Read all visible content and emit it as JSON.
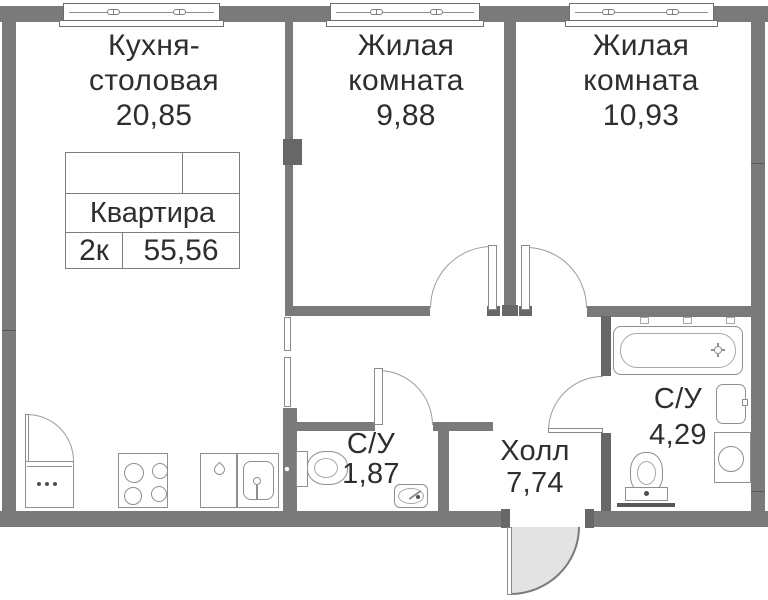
{
  "apartment": {
    "info_box": {
      "title": "Квартира",
      "layout": "2к",
      "total_area": "55,56"
    },
    "rooms": [
      {
        "name": "Кухня-",
        "name2": "столовая",
        "area": "20,85"
      },
      {
        "name": "Жилая",
        "name2": "комната",
        "area": "9,88"
      },
      {
        "name": "Жилая",
        "name2": "комната",
        "area": "10,93"
      },
      {
        "name": "С/У",
        "area": "1,87"
      },
      {
        "name": "Холл",
        "area": "7,74"
      },
      {
        "name": "С/У",
        "area": "4,29"
      }
    ],
    "fixtures": [
      "window",
      "fridge",
      "stove",
      "kitchen-cabinet",
      "kitchen-sink",
      "toilet",
      "hand-sink",
      "bathtub",
      "bathroom-sink",
      "washing-machine",
      "entrance-door"
    ],
    "colors": {
      "wall": "#7a7a7a",
      "wall_dark": "#676767",
      "fixture_outline": "#8f8f8f",
      "door_arc": "#9c9c9c",
      "entrance_door_fill": "#e3e3e3",
      "text": "#2e2e2e",
      "background": "#ffffff"
    }
  }
}
